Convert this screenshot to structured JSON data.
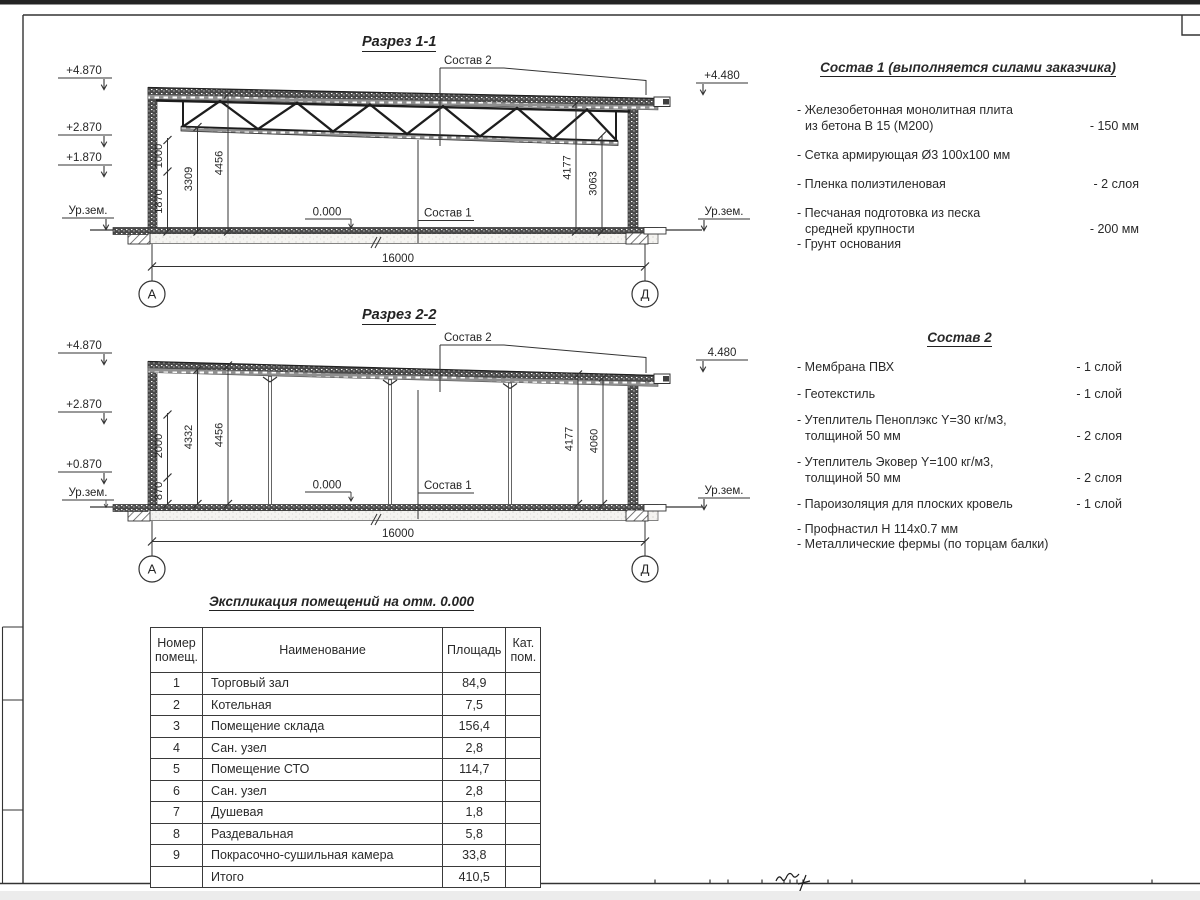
{
  "page": {
    "paper": "#ffffff",
    "ink": "#333333"
  },
  "drawing": {
    "s1": {
      "title": "Разрез 1-1",
      "callout_roof": "Состав 2",
      "callout_floor": "Состав 1",
      "zero": "0.000",
      "span": "16000",
      "axis_left": "А",
      "axis_right": "Д",
      "elev": [
        "+4.870",
        "+2.870",
        "+1.870",
        "Ур.зем."
      ],
      "elev_r": [
        "+4.480",
        "Ур.зем."
      ],
      "dims": [
        "1870",
        "1000",
        "3309",
        "4456"
      ],
      "dims_r": [
        "4177",
        "3063"
      ]
    },
    "s2": {
      "title": "Разрез 2-2",
      "callout_roof": "Состав 2",
      "callout_floor": "Состав 1",
      "zero": "0.000",
      "span": "16000",
      "axis_left": "А",
      "axis_right": "Д",
      "elev": [
        "+4.870",
        "+2.870",
        "+0.870",
        "Ур.зем."
      ],
      "elev_r": [
        "4.480",
        "Ур.зем."
      ],
      "dims": [
        "870",
        "2000",
        "4332",
        "4456"
      ],
      "dims_r": [
        "4177",
        "4060"
      ]
    }
  },
  "sostav1": {
    "title": "Состав 1 (выполняется силами заказчика)",
    "items": [
      {
        "l1": "- Железобетонная  монолитная плита",
        "l2": "из бетона В 15 (М200)",
        "v": "- 150 мм"
      },
      {
        "l1": "- Сетка армирующая Ø3 100х100 мм",
        "l2": "",
        "v": ""
      },
      {
        "l1": "- Пленка полиэтиленовая",
        "l2": "",
        "v": "-  2 слоя"
      },
      {
        "l1": "- Песчаная подготовка из песка",
        "l2": "средней крупности",
        "v": "- 200 мм"
      },
      {
        "l1": "- Грунт основания",
        "l2": "",
        "v": ""
      }
    ]
  },
  "sostav2": {
    "title": "Состав 2",
    "items": [
      {
        "l1": "- Мембрана ПВХ",
        "l2": "",
        "v": "- 1 слой"
      },
      {
        "l1": "- Геотекстиль",
        "l2": "",
        "v": "- 1 слой"
      },
      {
        "l1": "- Утеплитель Пеноплэкс Y=30 кг/м3,",
        "l2": "толщиной 50 мм",
        "v": "- 2 слоя"
      },
      {
        "l1": "- Утеплитель Эковер Y=100 кг/м3,",
        "l2": "толщиной 50 мм",
        "v": "- 2 слоя"
      },
      {
        "l1": "- Пароизоляция для плоских кровель",
        "l2": "",
        "v": "- 1 слой"
      },
      {
        "l1": "- Профнастил Н 114х0.7 мм",
        "l2": "",
        "v": ""
      },
      {
        "l1": "- Металлические фермы (по торцам балки)",
        "l2": "",
        "v": ""
      }
    ]
  },
  "table": {
    "title": "Экспликация помещений на отм. 0.000",
    "headers": {
      "col1a": "Номер",
      "col1b": "помещ.",
      "col2": "Наименование",
      "col3": "Площадь",
      "col4a": "Кат.",
      "col4b": "пом."
    },
    "rows": [
      [
        "1",
        "Торговый зал",
        "84,9"
      ],
      [
        "2",
        "Котельная",
        "7,5"
      ],
      [
        "3",
        "Помещение склада",
        "156,4"
      ],
      [
        "4",
        "Сан. узел",
        "2,8"
      ],
      [
        "5",
        "Помещение СТО",
        "114,7"
      ],
      [
        "6",
        "Сан. узел",
        "2,8"
      ],
      [
        "7",
        "Душевая",
        "1,8"
      ],
      [
        "8",
        "Раздевальная",
        "5,8"
      ],
      [
        "9",
        "Покрасочно-сушильная камера",
        "33,8"
      ],
      [
        "",
        "Итого",
        "410,5"
      ]
    ]
  }
}
